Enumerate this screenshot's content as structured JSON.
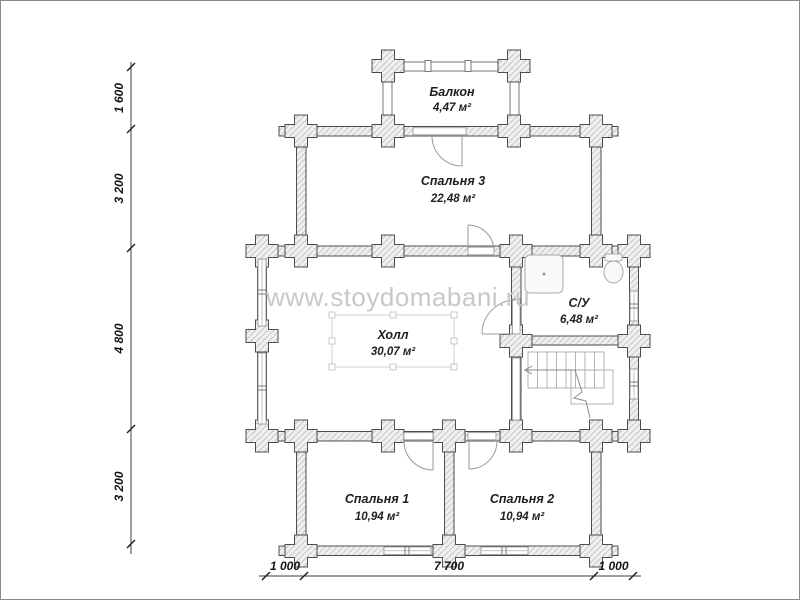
{
  "watermark": "www.stoydomabani.ru",
  "rooms": {
    "balcony": {
      "name": "Балкон",
      "area": "4,47 м²"
    },
    "bedroom3": {
      "name": "Спальня 3",
      "area": "22,48 м²"
    },
    "hall": {
      "name": "Холл",
      "area": "30,07 м²"
    },
    "bathroom": {
      "name": "С/У",
      "area": "6,48 м²"
    },
    "bedroom1": {
      "name": "Спальня 1",
      "area": "10,94 м²"
    },
    "bedroom2": {
      "name": "Спальня 2",
      "area": "10,94 м²"
    }
  },
  "dimensions": {
    "left": [
      "1 600",
      "3 200",
      "4 800",
      "3 200"
    ],
    "bottom": [
      "1 000",
      "7 700",
      "1 000"
    ]
  },
  "colors": {
    "wall_outline": "#4d4d4d",
    "wall_hatch": "#c6c6c6",
    "watermark_gray": "#c8c8c8",
    "text_black": "#1f1f1f"
  }
}
